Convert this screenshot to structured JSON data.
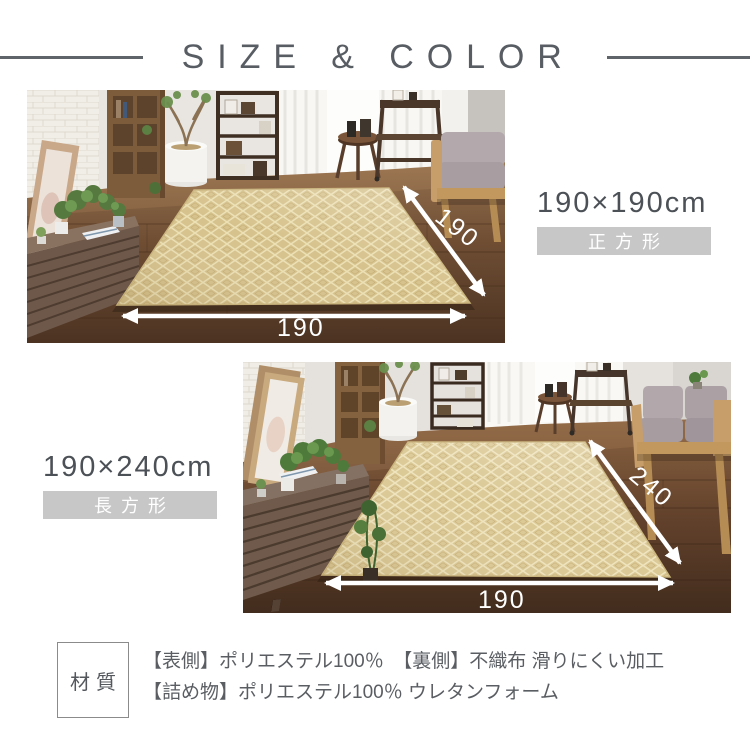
{
  "header": {
    "title": "SIZE & COLOR"
  },
  "sections": [
    {
      "size": "190×190cm",
      "shape_badge": "正方形",
      "width_label": "190",
      "depth_label": "190"
    },
    {
      "size": "190×240cm",
      "shape_badge": "長方形",
      "width_label": "190",
      "depth_label": "240"
    }
  ],
  "material": {
    "label": "材質",
    "lines": [
      "【表側】ポリエステル100％　【裏側】不織布 滑りにくい加工",
      "【詰め物】ポリエステル100％ ウレタンフォーム"
    ]
  },
  "colors": {
    "header_text": "#585d64",
    "size_text": "#4c5157",
    "badge_bg": "#c7c7c7",
    "badge_text": "#ffffff",
    "arrow": "#ffffff",
    "rug_beige": "#d8c592",
    "floor_brown": "#6b4c33"
  }
}
